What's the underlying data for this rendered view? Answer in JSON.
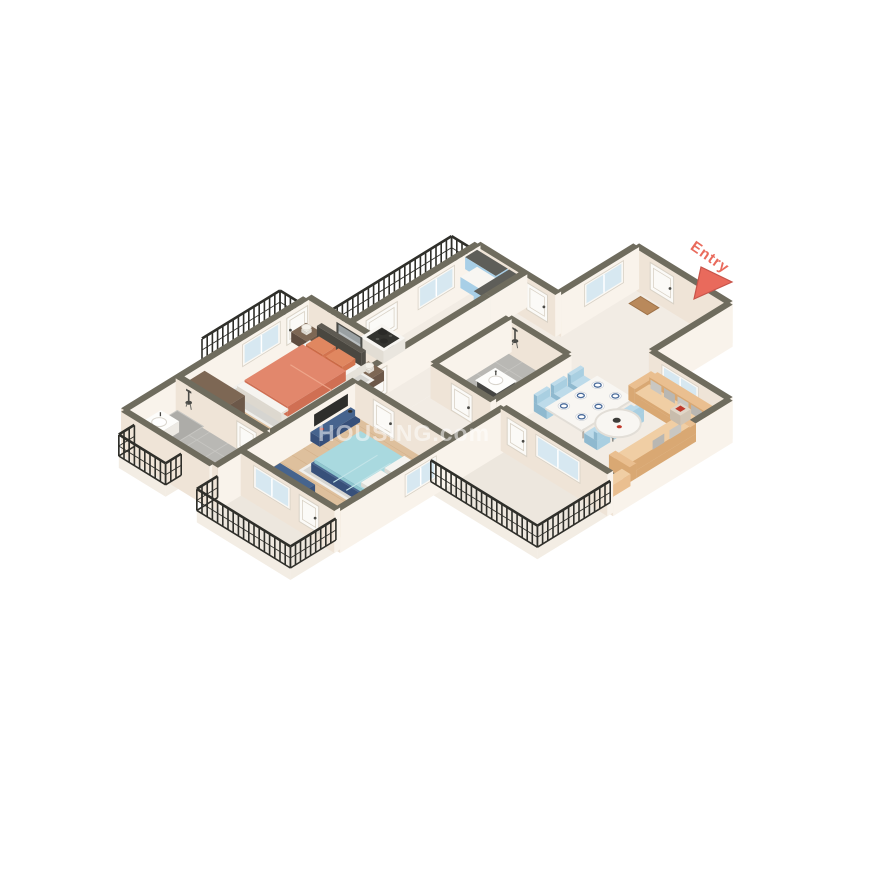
{
  "meta": {
    "app": "3D isometric apartment floor plan render",
    "watermark": "HOUSING.com"
  },
  "entry": {
    "label": "Entry"
  },
  "colors": {
    "wallTop": "#6F6C5E",
    "wallS": "#EFE4D7",
    "wallE": "#F9F3EB",
    "plinth": "#F3EDE4",
    "wood": "#DEC09D",
    "woodLine": "#CDA980",
    "marble": "#F2ECE4",
    "tile": "#B9B8B4",
    "tileLine": "#C7C6C2",
    "balcony": "#EDE7DE",
    "railing": "#2F2F2A",
    "doorWhite": "#FBFAF7",
    "doorFrame": "#D9D2C6",
    "frameWhite": "#FAF8F4",
    "glass": "#D7E8F1",
    "white": "#F6F4F0",
    "coral": "#E2876C",
    "coralSide": "#D06F53",
    "coralPillow": "#E08760",
    "rug": "#D6D5D1",
    "rugEdge": "#F0EFEC",
    "navy": "#46648E",
    "navyDark": "#37507A",
    "blueLight": "#A9D9DF",
    "blueSide": "#8FC6CE",
    "pillowWhite": "#F5F4F0",
    "brown": "#6C5849",
    "brownTop": "#7D6754",
    "brownDark": "#5E4C3F",
    "tan": "#EABF90",
    "tanLight": "#F0CEA4",
    "tanDark": "#D9A873",
    "grayPillow": "#C9C7C2",
    "grayPillow2": "#B9B7B2",
    "chairBlue": "#A9CFE1",
    "chairBlueTop": "#BDDBEA",
    "chairBlueSide": "#8FB9CF",
    "tableWhite": "#F8F6F2",
    "tableEdge": "#E2DED7",
    "kitchenBlue": "#A8CFE7",
    "cabinetDarkTop": "#5E5E59",
    "hob": "#33332F",
    "charcoal": "#5A5A57",
    "basinWhite": "#FDFDFB",
    "entry": "#E96A5C",
    "headboard": "#5E5A52"
  },
  "rooms": [
    {
      "name": "entry-foyer",
      "furniture": [
        "entry-door",
        "doormat"
      ]
    },
    {
      "name": "living-dining",
      "furniture": [
        "l-shaped-sofa",
        "gray-pillows",
        "coffee-table",
        "side-table",
        "dining-table",
        "six-blue-chairs",
        "plates",
        "sideboard"
      ]
    },
    {
      "name": "kitchen",
      "furniture": [
        "blue-upper-cabinet",
        "blue-base-cabinet",
        "blue-tall-unit",
        "counter-with-hob",
        "pots"
      ]
    },
    {
      "name": "service-balcony",
      "furniture": [
        "railing"
      ]
    },
    {
      "name": "master-bedroom",
      "furniture": [
        "coral-double-bed",
        "nightstands",
        "lamps",
        "wall-art",
        "rug",
        "wardrobe"
      ]
    },
    {
      "name": "master-balcony",
      "furniture": [
        "railing"
      ]
    },
    {
      "name": "master-bathroom",
      "furniture": [
        "shower",
        "vanity-basin",
        "toilet"
      ]
    },
    {
      "name": "bedroom-2",
      "furniture": [
        "blue-double-bed",
        "tv-panel",
        "tv-console",
        "bench",
        "rug"
      ]
    },
    {
      "name": "bedroom-2-balcony",
      "furniture": [
        "railing"
      ]
    },
    {
      "name": "common-bathroom",
      "furniture": [
        "shower",
        "vanity-basin"
      ]
    },
    {
      "name": "living-balcony",
      "furniture": [
        "railing"
      ]
    }
  ]
}
